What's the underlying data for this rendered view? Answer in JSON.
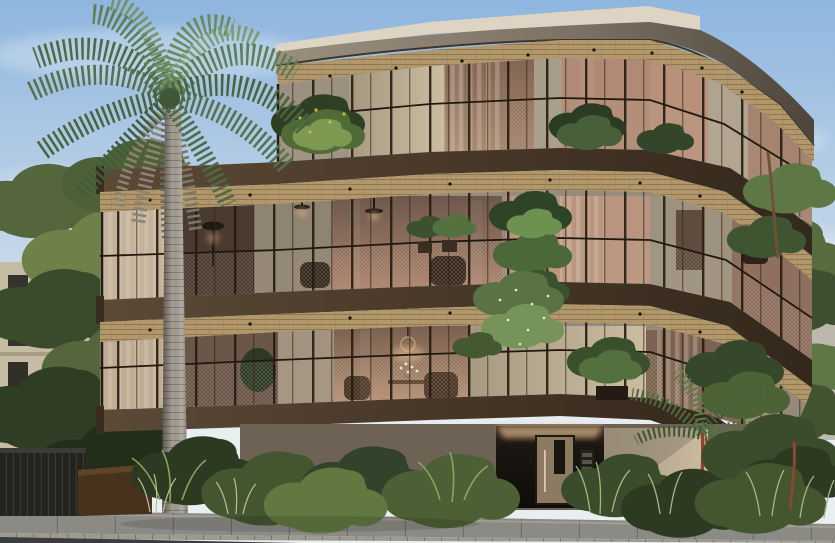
{
  "meta": {
    "title": "Architectural rendering: curved contemporary apartment building, street view, daytime",
    "image_width": 835,
    "image_height": 543
  },
  "scene": {
    "setting": "sunny day, clear hazy-blue sky, tree-lined street",
    "building": {
      "floors_visible": 3,
      "style": "curved bronze-and-wood facade sweeping down at the right corner",
      "roof": "cream parapet slab over a taupe curved fascia band",
      "soffits": "timber plank ceilings with recessed downlights on every level",
      "balustrades": "dark bronze frames with fine golden mesh infill panels",
      "balcony_bands": "three dark bronze fascia bands wrapping the balconies",
      "interiors": "warm amber-lit rooms with curtains, pendant lights, armchairs and wicker furniture",
      "ground_level": "recessed entry with glazed door, vertical pull handle, intercom/mailbox panel and cove lighting"
    },
    "vegetation": [
      "tall palm tree with green crown and hanging dried fronds at left",
      "potted shrubs and yellow-flowering planters on the top-floor balcony",
      "trailing green column of plants at the centre of the middle floor",
      "white-flecked cascading plant and potted shrub on the lower balcony",
      "dense tropical hedge, ferns and grasses across the street frontage",
      "large leafy background trees left and right",
      "small lawn patch at right behind shrubs"
    ],
    "street": [
      "grey concrete paver footpath with joint lines",
      "small-format curb stones",
      "dark asphalt road strip at bottom edge",
      "dark timber planter box and slatted fence at far left",
      "white bollard near the entry path"
    ],
    "background": [
      "beige multi-storey apartment block with dark windows behind trees at left",
      "pale building volumes glimpsed through trees at right"
    ]
  },
  "palette": {
    "sky_top": "#8fb6df",
    "sky_mid": "#c3d6e8",
    "sky_low": "#e9eef1",
    "parapet": "#ddd4c3",
    "fascia_light": "#9a8e7e",
    "fascia_dark": "#4e463c",
    "wood": "#b1976a",
    "wood_joint": "#86704b",
    "bronze": "#4f4133",
    "bronze_dark": "#2e2419",
    "frame": "#241c12",
    "wall": "#b7aa95",
    "wall_shade": "#9a8e7c",
    "wall_lit": "#cdc0a9",
    "glass_warm": "#c39a82",
    "glass_deep": "#7a604f",
    "glow": "#e6bd97",
    "mesh": "#c8bba0",
    "green_dark": "#25321e",
    "green": "#415233",
    "green_mid": "#5d7245",
    "green_light": "#7d9850",
    "green_pale": "#a9b77f",
    "grass": "#b9c193",
    "palm": "#5f7d52",
    "palm_dark": "#49633f",
    "palm_light": "#7e9c6c",
    "palm_dead": "#8b8375",
    "trunk": "#a39d92",
    "trunk_shade": "#6f6a60",
    "bg_building": "#c6bba3",
    "bg_window": "#35332b",
    "pave": "#8b8a84",
    "curb": "#9d9a8f",
    "road": "#3b3c3e",
    "planter": "#46321d",
    "door": "#8d7a62",
    "recess": "#14110d",
    "red_trunk": "#8a4631",
    "flower_yellow": "#c9b34a",
    "flower_white": "#e8ecd8"
  }
}
